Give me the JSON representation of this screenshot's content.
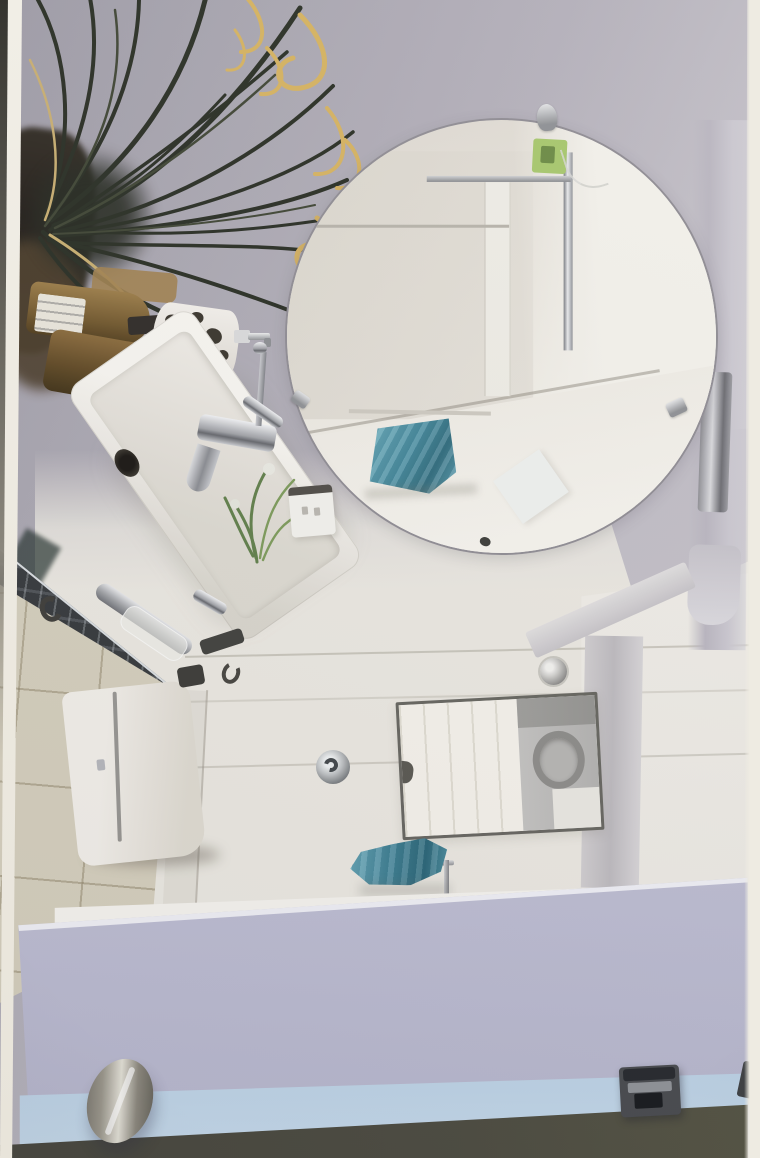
{
  "scene": {
    "type": "photograph",
    "description": "Sideways (90-degree rotated) photograph of a compact modern bathroom: large round frameless mirror on a lavender-grey wall, white vessel sink with chrome faucet on a dark marble counter edge, amber toiletry pump bottles, spotted ceramic soap dispenser, spiky houseplant with yellow curled ribbons, white toilet cistern on beige floor tiles, interior window with a washing machine visible, chrome towel bar with teal towel, and a pale-lavender glass shower door with a brushed-metal oval knob and dark latch along its edge.",
    "labels": {
      "photo": "Rotated bathroom photograph",
      "wall": "Lavender-grey bathroom wall",
      "plant": "Dark green houseplant with yellow curled ribbons",
      "plant_pot": "Dark plant pot",
      "mirror": "Round frameless wall mirror",
      "mirror_sticker": "Green label sticker on mirror",
      "mirror_clip": "Chrome mirror mounting clip",
      "towel_reflection": "Teal towel reflected in mirror",
      "shower_frame_reflection": "Chrome shower-door frame reflected in mirror",
      "bottles": "Amber toiletry pump bottles",
      "bottle_label": "White bottle label",
      "dispenser": "White soap dispenser with dark spots",
      "sink": "White rectangular vessel sink",
      "faucet": "Chrome single-lever faucet",
      "sink_plant": "Small green plant with white flowers",
      "switch": "White wall light switch",
      "counter": "Dark marble countertop edge",
      "floor": "Beige tiled floor",
      "toilet": "White toilet cistern",
      "p_trap": "Chrome sink drain pipe in protective wrap",
      "flush_button": "Round chrome flush button",
      "window": "Interior window",
      "appliance": "Washing machine seen through window",
      "spotlight": "Recessed chrome ceiling spotlight",
      "towel_bar": "Chrome towel bar",
      "towel": "Teal hand towel",
      "glass_door": "Pale lavender glass shower door panel",
      "door_knob": "Brushed nickel oval door knob",
      "door_latch": "Dark door latch fitting",
      "photo_border": "White edge of the printed photo"
    }
  },
  "palette": {
    "photo_border": "#f1eee6",
    "edge_dark": "#35342f",
    "wall_top": "#9d99a5",
    "wall_mid": "#b3afb9",
    "wall_light": "#cac7cf",
    "right_wall": "#d7d4da",
    "wall_cream": "#eae7df",
    "wall_bright": "#f3f1ea",
    "mirror_rim": "#8e8b93",
    "mirror_base": "#ddd8cf",
    "mirror_bright": "#f3f1e9",
    "sticker_green": "#a4c766",
    "towel_teal": "#4f9cb2",
    "towel_teal_dark": "#2e7387",
    "plant_dark": "#262b20",
    "plant_mid": "#3c4330",
    "ribbon_yellow": "#d7b158",
    "ribbon_pale": "#c9ad6b",
    "bottle_amber": "#8a6937",
    "label_white": "#e9e5da",
    "spot_dark": "#38322a",
    "sink_white": "#f4f2ed",
    "marble": "#33363a",
    "tile": "#d4cdba",
    "toilet_white": "#efece5",
    "window_frame": "#64635d",
    "appliance": "#b2b1af",
    "glass_lav": "#c9c8dc",
    "glass_lav2": "#b5b5cc",
    "glass_blue": "#82a3ce",
    "glass_blue_light": "#c3d8ea",
    "glass_line": "#3f5c84",
    "bottom_dark": "#4a493d",
    "knob_light": "#e2dfd4",
    "knob_dark": "#55524a",
    "latch_light": "#8e9196"
  }
}
